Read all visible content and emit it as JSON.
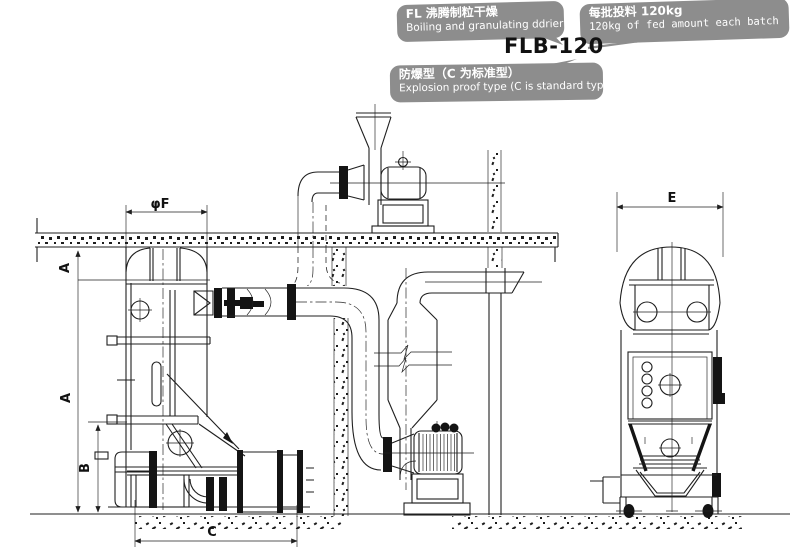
{
  "title": {
    "model": "FLB-120"
  },
  "callouts": {
    "product": {
      "zh": "FL 沸腾制粒干燥",
      "en": "Boiling and granulating ddrier"
    },
    "batch": {
      "zh": "每批投料 120kg",
      "en": "120kg of fed amount each batch"
    },
    "explosion": {
      "zh": "防爆型（C 为标准型）",
      "en": "Explosion proof type (C is standard type)"
    }
  },
  "dimensions": {
    "phiF": "φF",
    "A_upper": "A",
    "A_lower": "A",
    "B": "B",
    "C": "C",
    "E": "E"
  },
  "colors": {
    "bubble": "#8d8d8d",
    "bubble_text": "#ffffff",
    "line": "#1f1f1f",
    "background": "#ffffff"
  }
}
